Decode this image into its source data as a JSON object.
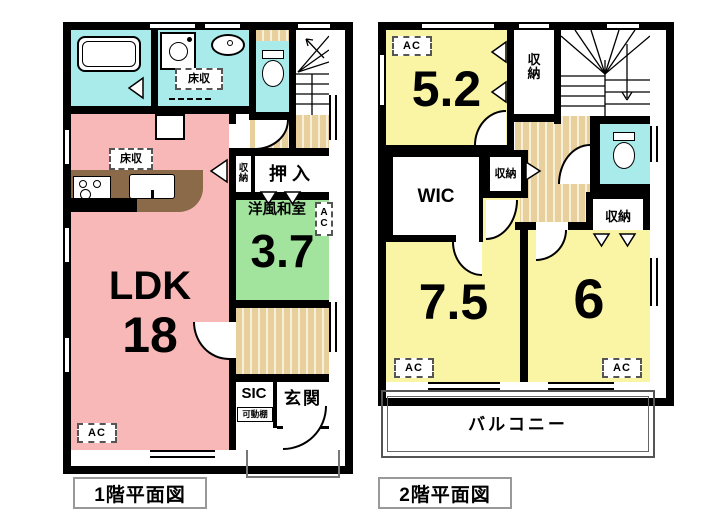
{
  "captions": {
    "floor1": "1階平面図",
    "floor2": "2階平面図"
  },
  "floor1": {
    "ldk": {
      "label": "LDK",
      "area": "18"
    },
    "washitsu": {
      "label": "洋風和室",
      "area": "3.7",
      "ac": "AC"
    },
    "oshiire": "押入",
    "closet": "収納",
    "floor_storage_washroom": "床収",
    "floor_storage_ldk": "床収",
    "sic": "SIC",
    "movable_shelf": "可動棚",
    "entrance": "玄関",
    "ac": "AC"
  },
  "floor2": {
    "room52": {
      "area": "5.2",
      "ac": "AC"
    },
    "room75": {
      "area": "7.5",
      "ac": "AC"
    },
    "room6": {
      "area": "6",
      "ac": "AC"
    },
    "wic": "WIC",
    "closet_top": "収納",
    "closet_mid": "収納",
    "closet_right": "収納",
    "balcony": "バルコニー"
  },
  "colors": {
    "ldk_pink": "#f8b8b8",
    "wet_cyan": "#a9ebeb",
    "washitsu_green": "#a2e39e",
    "bedroom_yellow": "#faf5a4",
    "wood_tan": "#e8d09c",
    "wall_black": "#000000"
  }
}
